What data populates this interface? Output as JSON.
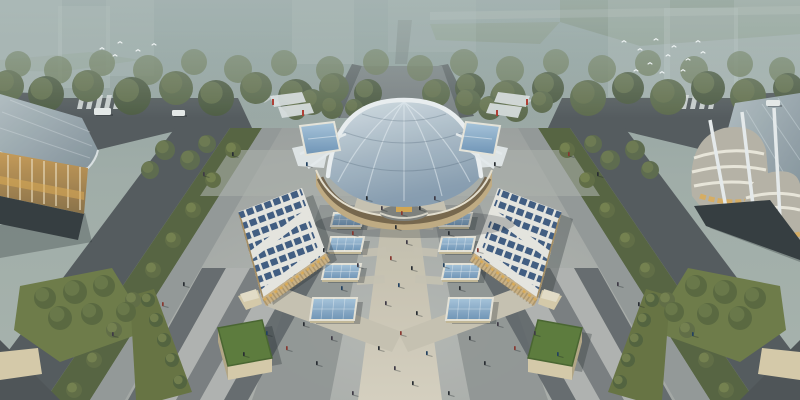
{
  "colors": {
    "sky_top": "#8fa09f",
    "sky_low": "#a9b3ad",
    "ghost": "#c9d4d2",
    "lawn": "#6e8166",
    "lawn2": "#77896c",
    "tree_back": "#6d7a57",
    "tree_dark": "#4d5a40",
    "tree_mid": "#5c694a",
    "tree_bright": "#77834c",
    "tree_hi": "#8a9158",
    "road": "#53585b",
    "road_dark": "#45494c",
    "walkway": "#949897",
    "median_green": "#55613e",
    "plaza_edge": "#9da09e",
    "plaza_band": "#8e9290",
    "stripe": [
      "#5e6366",
      "#b2b4b0",
      "#74787a"
    ],
    "corner_dark": "#4c5154",
    "path": "#c9c2b2",
    "path_bright": "#d8d1c0",
    "dome_rim": "#eef1f3",
    "base_beige": "#c2ab81",
    "storefront": "#6f5d42",
    "window_lit": "#e0ac52",
    "solar_roof": "#e9e7e1",
    "panel": "#3f5a80",
    "facade_warm": "#cdb183",
    "facade_side": "#a58c60",
    "louver": "#8a744e",
    "skylight_frame": "#e8e4d8",
    "skylight_base": "#c5b896",
    "green_roof": "#5b7a38",
    "green_roof_edge": "#47632c",
    "box_beige": "#d8cba9",
    "box_side": "#b5a684",
    "canopy_white": "#e0e4e5",
    "body_band": "#b8b3a6",
    "band_line": "#ede8dc",
    "glass_wing": "#8fa3ad",
    "base_dark": "#32383b",
    "esplanade": "#7c8284",
    "esplanade_edge": "#5d6365",
    "shadow": "rgba(22,28,34,0.28)",
    "bird": "#f4f7f7",
    "red_accent": "#b03a30",
    "car_white": "#e8ebea"
  },
  "scene": {
    "ghosts": [
      [
        0,
        0,
        62,
        92,
        0.32
      ],
      [
        58,
        6,
        52,
        82,
        0.26
      ],
      [
        106,
        0,
        48,
        76,
        0.22
      ],
      [
        292,
        0,
        62,
        64,
        0.24
      ],
      [
        388,
        0,
        88,
        52,
        0.18
      ],
      [
        608,
        0,
        62,
        97,
        0.28
      ],
      [
        664,
        8,
        74,
        118,
        0.36
      ],
      [
        734,
        0,
        66,
        126,
        0.3
      ]
    ],
    "tree_band_back": [
      [
        18,
        64,
        13
      ],
      [
        58,
        70,
        14
      ],
      [
        102,
        63,
        13
      ],
      [
        148,
        70,
        15
      ],
      [
        194,
        62,
        13
      ],
      [
        238,
        69,
        14
      ],
      [
        284,
        63,
        13
      ],
      [
        330,
        70,
        14
      ],
      [
        376,
        62,
        13
      ],
      [
        420,
        68,
        13
      ],
      [
        464,
        63,
        14
      ],
      [
        510,
        70,
        14
      ],
      [
        556,
        62,
        13
      ],
      [
        602,
        69,
        14
      ],
      [
        648,
        63,
        13
      ],
      [
        694,
        70,
        14
      ],
      [
        740,
        64,
        13
      ],
      [
        782,
        70,
        13
      ]
    ],
    "tree_band_front": [
      [
        8,
        86,
        16
      ],
      [
        46,
        94,
        18
      ],
      [
        88,
        86,
        16
      ],
      [
        132,
        96,
        19
      ],
      [
        176,
        88,
        17
      ],
      [
        216,
        98,
        18
      ],
      [
        256,
        88,
        16
      ],
      [
        296,
        97,
        18
      ],
      [
        334,
        88,
        15
      ],
      [
        368,
        93,
        14
      ],
      [
        436,
        93,
        14
      ],
      [
        470,
        88,
        15
      ],
      [
        508,
        98,
        18
      ],
      [
        548,
        88,
        16
      ],
      [
        588,
        98,
        18
      ],
      [
        628,
        88,
        16
      ],
      [
        668,
        97,
        18
      ],
      [
        708,
        88,
        17
      ],
      [
        748,
        96,
        18
      ],
      [
        788,
        88,
        15
      ]
    ],
    "tree_clusters": [
      [
        312,
        102,
        13
      ],
      [
        332,
        108,
        11
      ],
      [
        296,
        110,
        10
      ],
      [
        468,
        102,
        13
      ],
      [
        490,
        108,
        12
      ],
      [
        516,
        110,
        12
      ],
      [
        542,
        102,
        11
      ],
      [
        354,
        108,
        9
      ]
    ],
    "road_trees_left": [
      [
        233,
        150,
        8
      ],
      [
        213,
        180,
        8
      ],
      [
        193,
        210,
        8
      ],
      [
        173,
        240,
        8
      ],
      [
        153,
        270,
        8
      ],
      [
        133,
        300,
        8
      ],
      [
        114,
        330,
        8
      ],
      [
        94,
        360,
        8
      ],
      [
        74,
        390,
        8
      ]
    ],
    "road_trees_right": [
      [
        567,
        150,
        8
      ],
      [
        587,
        180,
        8
      ],
      [
        607,
        210,
        8
      ],
      [
        627,
        240,
        8
      ],
      [
        647,
        270,
        8
      ],
      [
        667,
        300,
        8
      ],
      [
        687,
        330,
        8
      ],
      [
        706,
        360,
        8
      ],
      [
        726,
        390,
        8
      ]
    ],
    "plaza_trees": [
      [
        165,
        150,
        10
      ],
      [
        190,
        160,
        10
      ],
      [
        150,
        170,
        9
      ],
      [
        207,
        144,
        9
      ],
      [
        635,
        150,
        10
      ],
      [
        610,
        160,
        10
      ],
      [
        650,
        170,
        9
      ],
      [
        593,
        144,
        9
      ]
    ],
    "corner_trees_left": [
      [
        45,
        298,
        11
      ],
      [
        75,
        292,
        12
      ],
      [
        104,
        286,
        11
      ],
      [
        60,
        318,
        12
      ],
      [
        92,
        314,
        11
      ],
      [
        126,
        312,
        10
      ]
    ],
    "corner_trees_right": [
      [
        755,
        298,
        11
      ],
      [
        725,
        292,
        12
      ],
      [
        696,
        286,
        11
      ],
      [
        740,
        318,
        12
      ],
      [
        708,
        314,
        11
      ],
      [
        674,
        312,
        10
      ]
    ],
    "strip_trees_left": [
      [
        148,
        300,
        7
      ],
      [
        156,
        320,
        7
      ],
      [
        164,
        340,
        7
      ],
      [
        172,
        360,
        7
      ],
      [
        180,
        382,
        7
      ]
    ],
    "strip_trees_right": [
      [
        652,
        300,
        7
      ],
      [
        644,
        320,
        7
      ],
      [
        636,
        340,
        7
      ],
      [
        628,
        360,
        7
      ],
      [
        620,
        382,
        7
      ]
    ],
    "stripes_left": {
      "x0": 128,
      "dx": 24,
      "count": 5,
      "topOffset": 74,
      "topY": 268,
      "fillIdx": [
        0,
        1,
        2,
        1,
        0
      ]
    },
    "stripes_right": {
      "x0": 552,
      "dx": 24,
      "count": 5,
      "topOffset": -74,
      "topY": 268,
      "fillIdx": [
        0,
        1,
        2,
        1,
        0
      ]
    },
    "skylights": [
      [
        331,
        213,
        30,
        13
      ],
      [
        328,
        237,
        33,
        14
      ],
      [
        322,
        264,
        36,
        15
      ],
      [
        310,
        298,
        44,
        22
      ],
      [
        439,
        213,
        30,
        13
      ],
      [
        439,
        237,
        33,
        14
      ],
      [
        442,
        264,
        36,
        15
      ],
      [
        446,
        298,
        44,
        22
      ]
    ],
    "solar_left": {
      "clip": "clipSolarL",
      "poly": "238,212 302,188 326,253 262,298",
      "p1": [
        238,
        216
      ],
      "p2": [
        302,
        192
      ],
      "step": [
        3,
        10.75
      ],
      "rows": 8,
      "whiteStripes": [
        [
          242,
          262,
          314,
          208
        ],
        [
          258,
          297,
          330,
          243
        ]
      ]
    },
    "solar_right": {
      "clip": "clipSolarR",
      "poly": "562,212 498,188 474,253 538,298",
      "p1": [
        562,
        216
      ],
      "p2": [
        498,
        192
      ],
      "step": [
        -3,
        10.75
      ],
      "rows": 8,
      "whiteStripes": [
        [
          558,
          262,
          486,
          208
        ],
        [
          542,
          297,
          470,
          243
        ]
      ]
    },
    "storefronts": {
      "count": 11,
      "cx": 404,
      "cy": 180,
      "rx": 74,
      "ry": 33,
      "startDeg": 200,
      "endDeg": 340,
      "w": 9,
      "h": 6
    },
    "crosswalks": [
      {
        "x": 80,
        "y": 95,
        "n": 6
      },
      {
        "x": 666,
        "y": 95,
        "n": 6
      }
    ],
    "hatch": [
      [
        485,
        100
      ],
      [
        497,
        102
      ],
      [
        509,
        104
      ],
      [
        521,
        106
      ],
      [
        533,
        108
      ],
      [
        252,
        100
      ],
      [
        264,
        102
      ],
      [
        276,
        104
      ],
      [
        288,
        106
      ]
    ],
    "cars": [
      [
        94,
        108,
        17,
        7
      ],
      [
        172,
        110,
        13,
        6
      ],
      [
        766,
        100,
        14,
        6
      ]
    ],
    "people_colors": [
      "#23262c",
      "#3a3440",
      "#87322a",
      "#1e3c5c",
      "#4f4840"
    ],
    "people": [
      [
        395,
        225,
        0
      ],
      [
        406,
        240,
        1
      ],
      [
        390,
        256,
        2
      ],
      [
        411,
        266,
        0
      ],
      [
        398,
        283,
        3
      ],
      [
        385,
        301,
        1
      ],
      [
        416,
        311,
        0
      ],
      [
        400,
        331,
        2
      ],
      [
        378,
        346,
        0
      ],
      [
        426,
        351,
        3
      ],
      [
        394,
        366,
        1
      ],
      [
        412,
        381,
        0
      ],
      [
        352,
        231,
        2
      ],
      [
        323,
        248,
        0
      ],
      [
        357,
        263,
        1
      ],
      [
        341,
        286,
        3
      ],
      [
        303,
        322,
        0
      ],
      [
        331,
        336,
        1
      ],
      [
        286,
        346,
        2
      ],
      [
        316,
        361,
        0
      ],
      [
        266,
        331,
        3
      ],
      [
        243,
        352,
        0
      ],
      [
        352,
        391,
        1
      ],
      [
        448,
        231,
        0
      ],
      [
        477,
        248,
        2
      ],
      [
        443,
        263,
        3
      ],
      [
        459,
        286,
        0
      ],
      [
        497,
        322,
        1
      ],
      [
        469,
        336,
        0
      ],
      [
        514,
        346,
        2
      ],
      [
        484,
        361,
        0
      ],
      [
        534,
        331,
        1
      ],
      [
        557,
        352,
        3
      ],
      [
        448,
        391,
        0
      ],
      [
        381,
        206,
        1
      ],
      [
        419,
        206,
        0
      ],
      [
        401,
        211,
        2
      ],
      [
        366,
        196,
        0
      ],
      [
        434,
        196,
        1
      ],
      [
        183,
        282,
        0
      ],
      [
        162,
        302,
        2
      ],
      [
        617,
        282,
        1
      ],
      [
        638,
        302,
        0
      ],
      [
        692,
        332,
        3
      ],
      [
        112,
        332,
        1
      ],
      [
        232,
        152,
        0
      ],
      [
        203,
        172,
        1
      ],
      [
        568,
        152,
        2
      ],
      [
        597,
        172,
        0
      ],
      [
        306,
        162,
        3
      ],
      [
        494,
        162,
        0
      ]
    ],
    "birds": [
      [
        622,
        42
      ],
      [
        638,
        50
      ],
      [
        654,
        40
      ],
      [
        666,
        56
      ],
      [
        648,
        64
      ],
      [
        672,
        47
      ],
      [
        686,
        60
      ],
      [
        696,
        42
      ],
      [
        660,
        73
      ],
      [
        634,
        71
      ],
      [
        681,
        71
      ],
      [
        701,
        53
      ],
      [
        100,
        49
      ],
      [
        118,
        43
      ],
      [
        136,
        51
      ],
      [
        152,
        45
      ],
      [
        113,
        56
      ]
    ]
  }
}
